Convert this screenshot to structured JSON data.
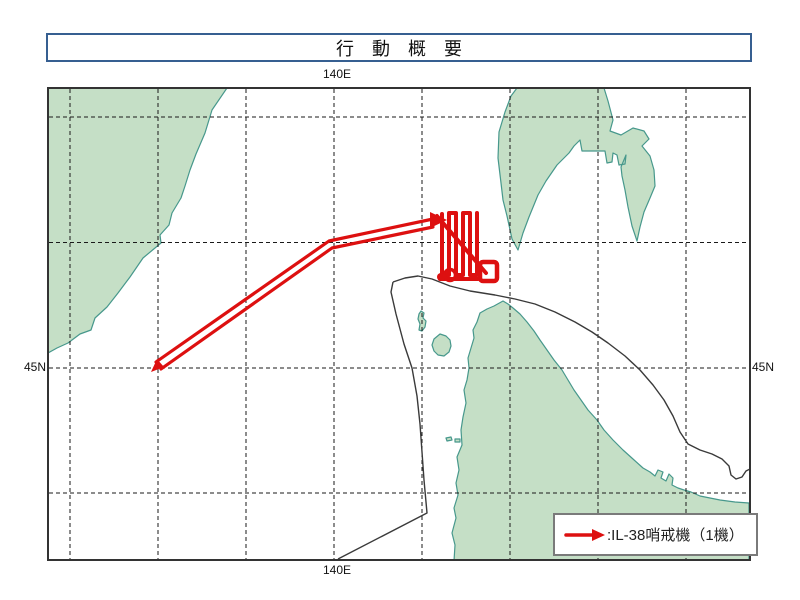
{
  "title": "行　動　概　要",
  "map": {
    "top_label": "140E",
    "bottom_label": "140E",
    "left_label": "45N",
    "right_label": "45N"
  },
  "legend": {
    "symbol": "red-arrow",
    "label": ":IL-38哨戒機（1機）"
  },
  "colors": {
    "title_border": "#365f91",
    "map_border": "#333333",
    "grid_line": "#1a1a1a",
    "land_fill": "#c5dfc6",
    "coast_stroke": "#47988c",
    "boundary_line": "#3a3a3a",
    "track_red": "#dd1010",
    "legend_border": "#7a7a7a"
  }
}
